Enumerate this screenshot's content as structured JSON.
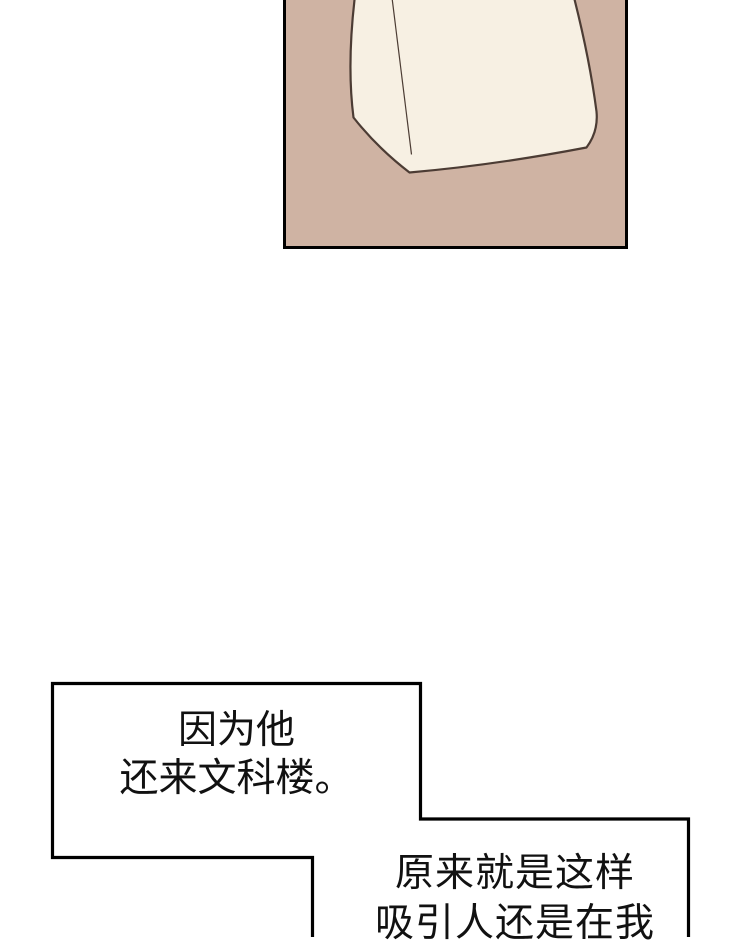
{
  "canvas": {
    "width_px": 740,
    "height_px": 937,
    "background_color": "#ffffff"
  },
  "panel": {
    "description": "comic panel cropped at the top edge of the image",
    "background_color": "#cfb3a3",
    "border_color": "#000000",
    "illustration": {
      "name": "paper-bag",
      "fill_color": "#f7f0e3",
      "outline_color": "#4c3c34"
    }
  },
  "speech_bubbles": {
    "border_color": "#000000",
    "fill_color": "#ffffff",
    "text_color": "#111111",
    "bubble_1": {
      "lines": [
        "因为他",
        "还来文科楼。"
      ]
    },
    "bubble_2": {
      "lines": [
        "原来就是这样",
        "吸引人还是在我"
      ]
    }
  }
}
